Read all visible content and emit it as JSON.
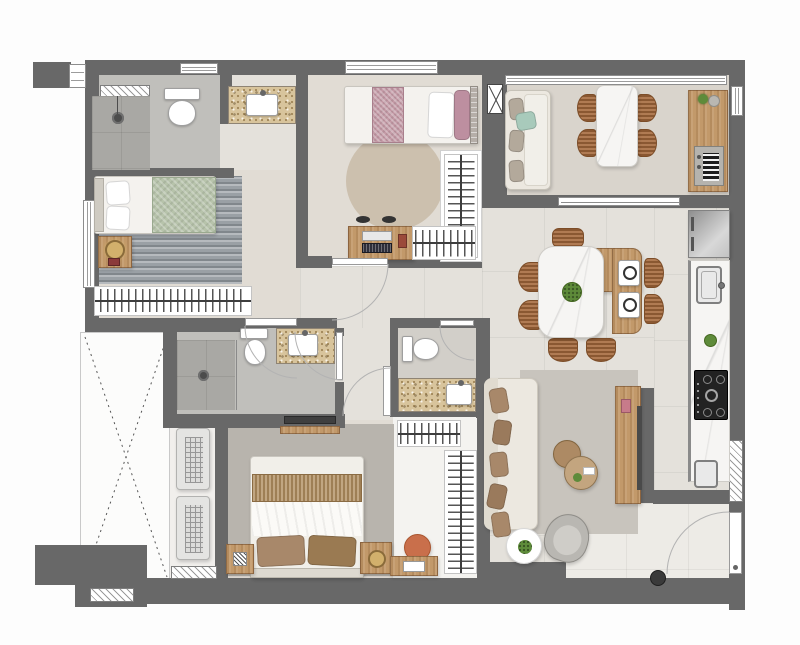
{
  "plan_title": "apartment-floor-plan",
  "palette": {
    "wall": "#686868",
    "floor": "#e4e1db",
    "floor_warm": "#e1dcd4",
    "floor_bath": "#c0bfbb",
    "floor_shower": "#a9a8a4",
    "floor_balcony": "#d9d4cc",
    "floor_light": "#edebe6",
    "granite": "#d8c49c",
    "wood": "#c2996a",
    "rug_dark": "#9aa0a5",
    "rug_round": "#ccc0ae",
    "rug_master": "#b8b4ad",
    "rug_living": "#c8c4bd",
    "green_blanket": "#b7c3ab",
    "pink_blanket": "#c49aa6",
    "pink_pillow": "#bd8fa0",
    "mint": "#a8cabb",
    "sofa_beige": "#ece8e0",
    "pillow_brown": "#a8886a",
    "chair_wicker": "#a5693b",
    "chair_orange": "#c96f4b",
    "appliance_black": "#222222",
    "steel": "#b9b7b2",
    "plant_green": "#5e8b3a",
    "lamp_gold": "#d2b06c"
  },
  "rooms": [
    {
      "name": "bathroom-1",
      "items": [
        "hatched-window",
        "shower-floor-drain",
        "toilet",
        "granite-vanity-sink"
      ]
    },
    {
      "name": "bedroom-1",
      "items": [
        "window",
        "single-bed-green-blanket",
        "pillows",
        "nightstand",
        "table-lamp",
        "textured-rug",
        "wardrobe-hanger-rack"
      ]
    },
    {
      "name": "bedroom-2",
      "items": [
        "window",
        "single-bed-pink-blanket",
        "pillows",
        "round-rug",
        "desk",
        "laptop",
        "desk-chair",
        "closet-hanger-racks"
      ]
    },
    {
      "name": "balcony-gourmet",
      "items": [
        "glass-railing",
        "sofa",
        "mint-cushion",
        "marble-table",
        "four-chairs",
        "wood-counter",
        "barbecue-grill",
        "plant",
        "shaft-box",
        "side-window"
      ]
    },
    {
      "name": "dining-area",
      "items": [
        "marble-table",
        "wood-extension",
        "seven-wicker-chairs",
        "centerpiece-plant",
        "two-place-settings",
        "sliding-door"
      ]
    },
    {
      "name": "kitchen",
      "items": [
        "refrigerator",
        "marble-counter",
        "sink-faucet",
        "plant",
        "gas-cooktop",
        "laundry-tank-sink"
      ]
    },
    {
      "name": "living-room",
      "items": [
        "beige-sofa",
        "five-brown-cushions",
        "rug",
        "two-round-coffee-tables",
        "wood-tv-console",
        "tv-panel",
        "gray-armchair",
        "round-side-table",
        "plant"
      ]
    },
    {
      "name": "master-bedroom",
      "items": [
        "double-bed",
        "two-brown-pillows",
        "woven-runner",
        "two-nightstands",
        "table-lamp",
        "speckled-rug",
        "wall-tv"
      ]
    },
    {
      "name": "master-closet",
      "items": [
        "hanger-rack-top",
        "hanger-rack-side",
        "desk",
        "orange-chair"
      ]
    },
    {
      "name": "master-bathroom",
      "items": [
        "shower-floor-drain",
        "glass-partition",
        "toilet",
        "granite-vanity-sink"
      ]
    },
    {
      "name": "powder-room",
      "items": [
        "toilet",
        "granite-vanity-sink"
      ]
    },
    {
      "name": "service-area",
      "items": [
        "hatched-window",
        "entry-door",
        "floor-bin"
      ]
    },
    {
      "name": "ac-ledge",
      "items": [
        "condenser-unit-1",
        "condenser-unit-2",
        "hatched-windows"
      ]
    },
    {
      "name": "open-void",
      "items": [
        "dashed-x-marking"
      ]
    }
  ]
}
